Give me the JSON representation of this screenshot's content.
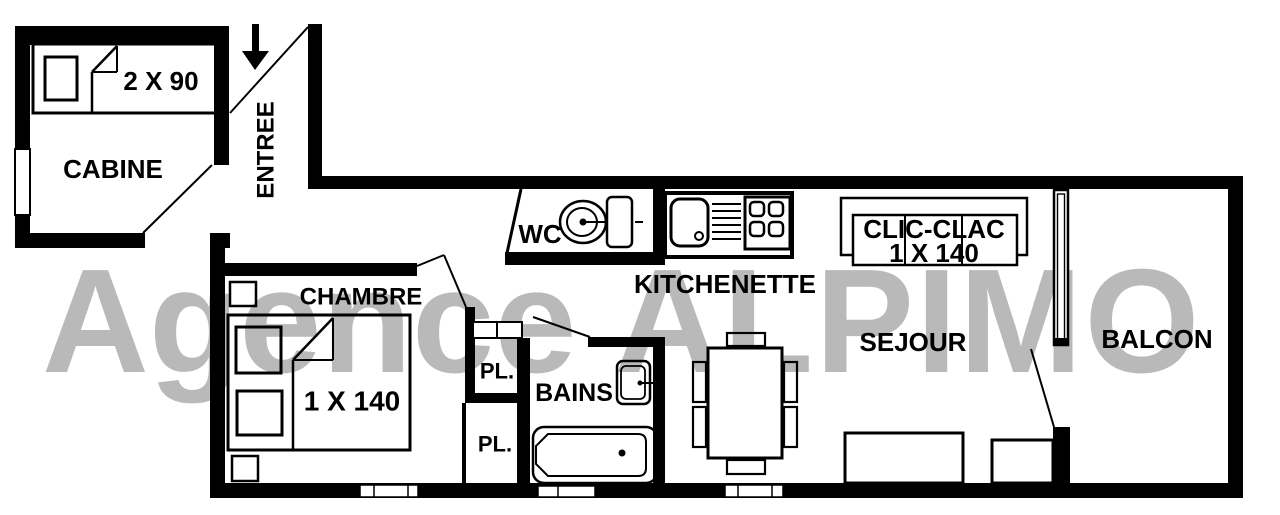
{
  "watermark": {
    "word1": "Agence",
    "word2": "ALPIMO"
  },
  "colors": {
    "wall": "#000000",
    "line": "#000000",
    "watermark": "#b9b9b9",
    "background": "#ffffff"
  },
  "rooms": {
    "cabine": {
      "label": "CABINE"
    },
    "entree": {
      "label": "ENTREE"
    },
    "chambre": {
      "label": "CHAMBRE"
    },
    "wc": {
      "label": "WC"
    },
    "kitchenette": {
      "label": "KITCHENETTE"
    },
    "bains": {
      "label": "BAINS"
    },
    "placard_upper": {
      "label": "PL."
    },
    "placard_lower": {
      "label": "PL."
    },
    "sejour": {
      "label": "SEJOUR"
    },
    "balcon": {
      "label": "BALCON"
    }
  },
  "furniture": {
    "cabine_bed": {
      "label": "2 X 90"
    },
    "chambre_bed": {
      "label": "1 X 140"
    },
    "clic_clac": {
      "line1": "CLIC-CLAC",
      "line2": "1 X 140"
    }
  }
}
